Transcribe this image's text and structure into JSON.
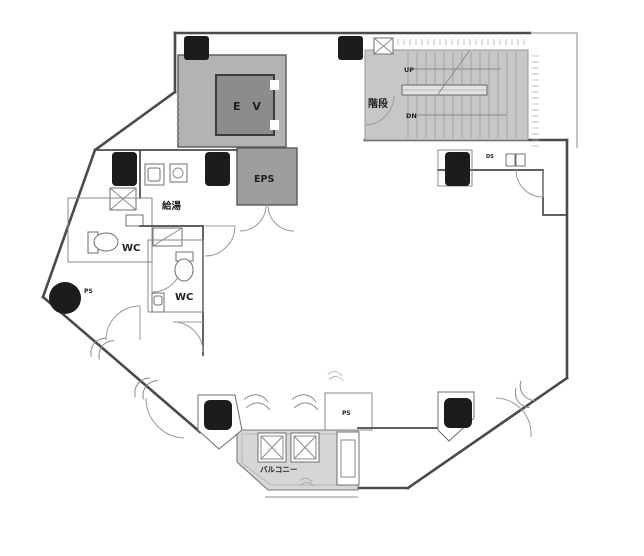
{
  "title": "office-floor-plan",
  "colors": {
    "wall": "#4a4a4a",
    "shaft_fill": "#b3b3b3",
    "ev_car_fill": "#8c8c8c",
    "eps_fill": "#9e9e9e",
    "stair_fill": "#c7c7c7",
    "balcony_fill": "#d6d6d6",
    "column_fill": "#1c1c1c"
  },
  "rooms": {
    "elevator": {
      "label": "E V"
    },
    "eps": {
      "label": "EPS"
    },
    "stairs": {
      "label": "階段",
      "up_label": "UP",
      "down_label": "DN"
    },
    "kitchenette": {
      "label": "給湯"
    },
    "wc_left": {
      "label": "WC"
    },
    "wc_right": {
      "label": "WC"
    },
    "pipe_shaft_circle": {
      "label": "PS"
    },
    "pipe_shaft_bottom": {
      "label": "PS"
    },
    "duct_space": {
      "label": "DS"
    },
    "balcony": {
      "label": "バルコニー"
    }
  }
}
